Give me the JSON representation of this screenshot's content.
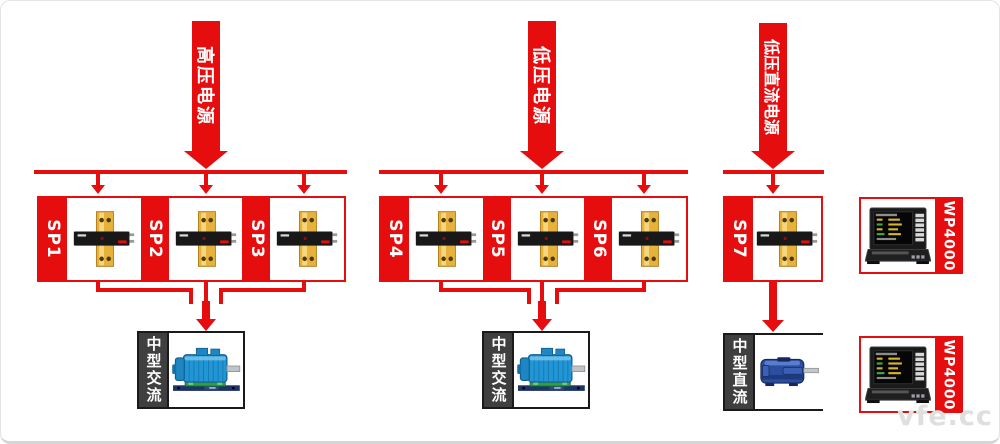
{
  "watermark": "vfe.cc",
  "banners": [
    {
      "label": "高压电源"
    },
    {
      "label": "低压电源"
    },
    {
      "label": "低压直流电源"
    }
  ],
  "groups": [
    {
      "sp": [
        "SP1",
        "SP2",
        "SP3"
      ],
      "load": "中型交流"
    },
    {
      "sp": [
        "SP4",
        "SP5",
        "SP6"
      ],
      "load": "中型交流"
    },
    {
      "sp": [
        "SP7"
      ],
      "load": "中型直流"
    }
  ],
  "analyzers": [
    {
      "label": "WP4000"
    },
    {
      "label": "WP4000"
    }
  ],
  "colors": {
    "accent_red": "#e60d0e",
    "strip_gray": "#3f3f3f",
    "busbar_gold": "#e6b23c",
    "ac_motor_blue": "#2196d6",
    "dc_motor_blue": "#2b4ea0"
  }
}
